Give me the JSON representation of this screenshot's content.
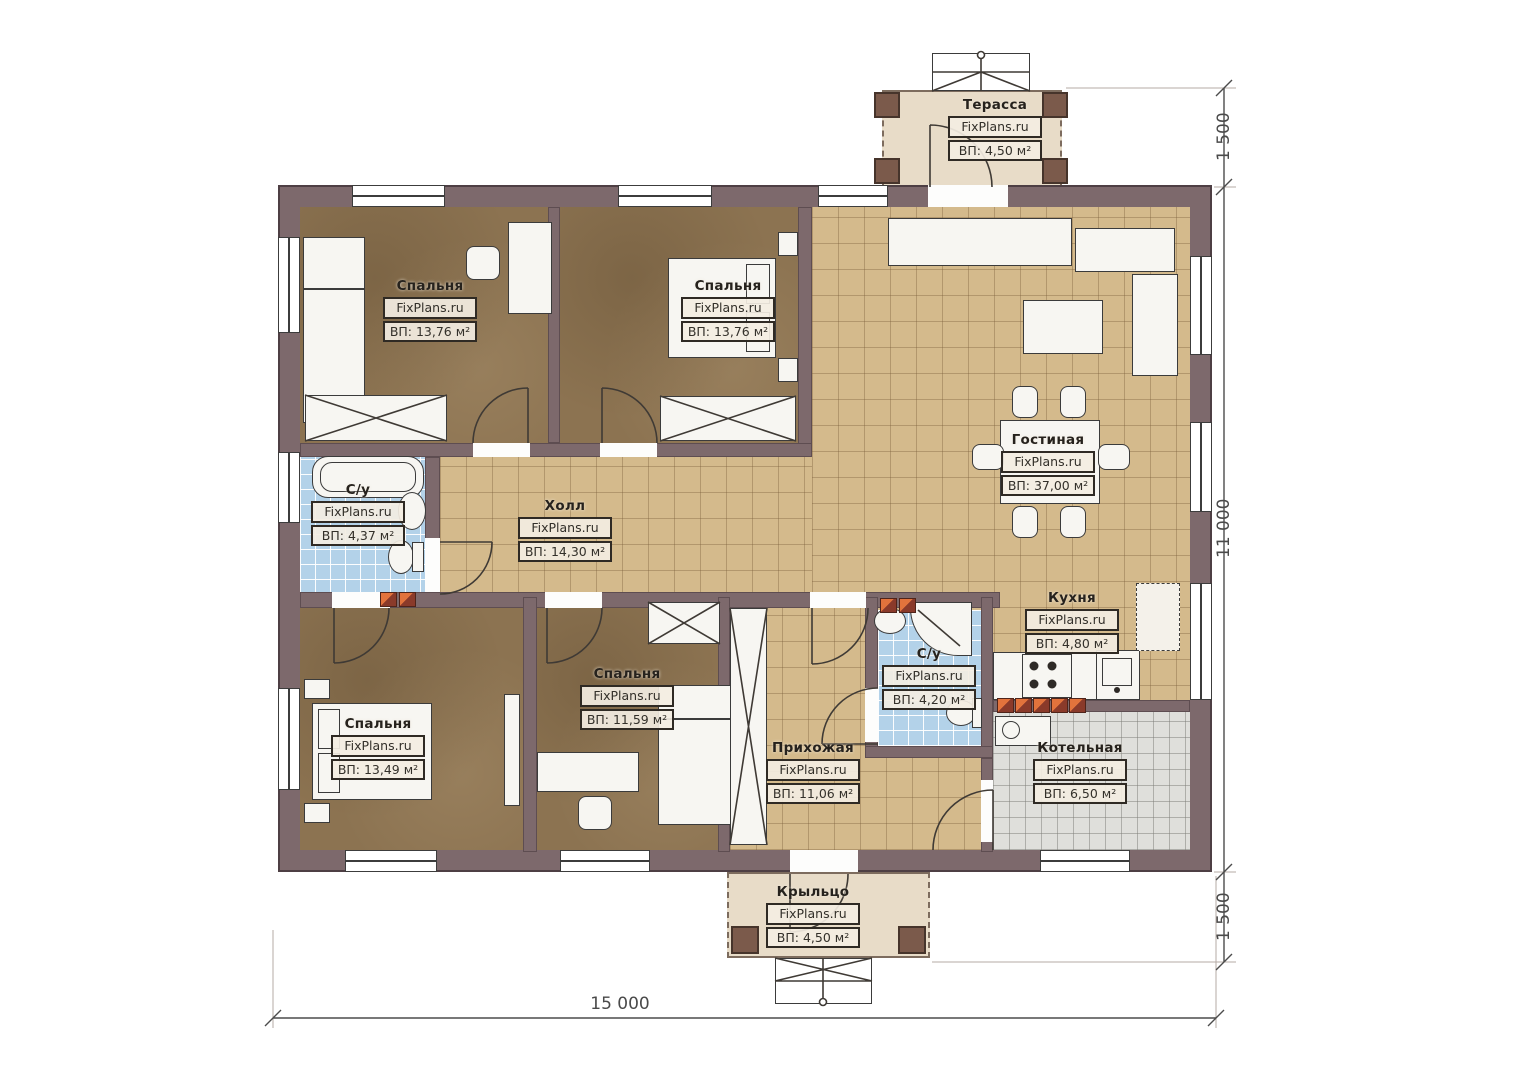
{
  "brand": "FixPlans.ru",
  "rooms": {
    "terrace": {
      "name": "Терасса",
      "area": "ВП: 4,50 м²"
    },
    "bedroom_top_left": {
      "name": "Спальня",
      "area": "ВП: 13,76 м²"
    },
    "bedroom_top_middle": {
      "name": "Спальня",
      "area": "ВП: 13,76 м²"
    },
    "living": {
      "name": "Гостиная",
      "area": "ВП: 37,00 м²"
    },
    "bath_left": {
      "name": "С/у",
      "area": "ВП: 4,37 м²"
    },
    "hall": {
      "name": "Холл",
      "area": "ВП: 14,30 м²"
    },
    "kitchen": {
      "name": "Кухня",
      "area": "ВП: 4,80 м²"
    },
    "bath_middle": {
      "name": "С/у",
      "area": "ВП: 4,20 м²"
    },
    "bedroom_bottom_middle": {
      "name": "Спальня",
      "area": "ВП: 11,59 м²"
    },
    "bedroom_bottom_left": {
      "name": "Спальня",
      "area": "ВП: 13,49 м²"
    },
    "entry": {
      "name": "Прихожая",
      "area": "ВП: 11,06 м²"
    },
    "boiler": {
      "name": "Котельная",
      "area": "ВП: 6,50 м²"
    },
    "porch": {
      "name": "Крыльцо",
      "area": "ВП: 4,50 м²"
    }
  },
  "dimensions": {
    "right_top": "1 500",
    "right_middle": "11 000",
    "right_bottom": "1 500",
    "bottom_width": "15 000"
  },
  "colors": {
    "wall": "#7d696c",
    "tile_beige": "#d4ba8c",
    "bedroom_floor": "#8c7351",
    "tile_blue": "#b3d2e9",
    "tile_grey": "#dfdfdb",
    "deck": "#e8dcc8",
    "accent_red": "#8a3a2a",
    "accent_orange": "#e2733c"
  }
}
